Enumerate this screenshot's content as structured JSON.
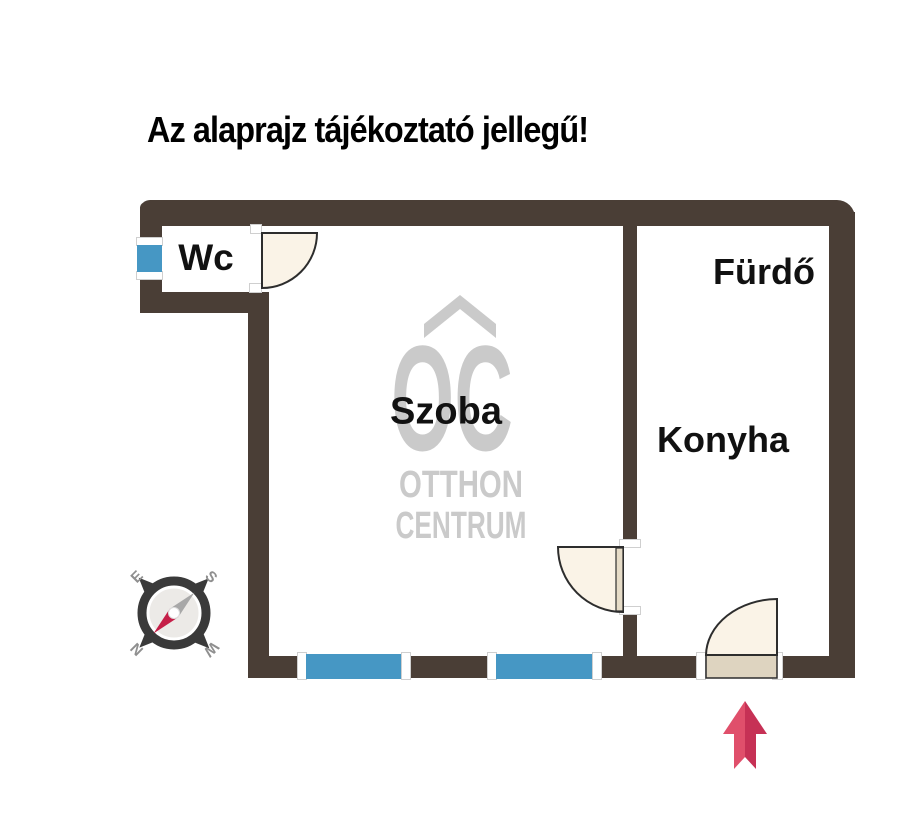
{
  "title": "Az alaprajz tájékoztató jellegű!",
  "watermark": {
    "initials": "OC",
    "line1": "OTTHON",
    "line2": "CENTRUM"
  },
  "rooms": {
    "wc": "Wc",
    "szoba": "Szoba",
    "furdo": "Fürdő",
    "konyha": "Konyha"
  },
  "compass": {
    "top_left": "E",
    "top_right": "S",
    "bottom_left": "N",
    "bottom_right": "W"
  },
  "colors": {
    "wall": "#4a3e36",
    "window": "#4697c4",
    "door": "#faf3e7",
    "door_panel": "#ded4c0",
    "door_outline": "#2d2d2d",
    "watermark": "#cacaca",
    "arrow_light": "#e04f6b",
    "arrow_dark": "#c63155",
    "compass_dark": "#3a3a3a",
    "compass_red": "#c51f48",
    "compass_gray": "#a8a8a8",
    "compass_letter": "#8f8f8f",
    "label": "#111111"
  }
}
